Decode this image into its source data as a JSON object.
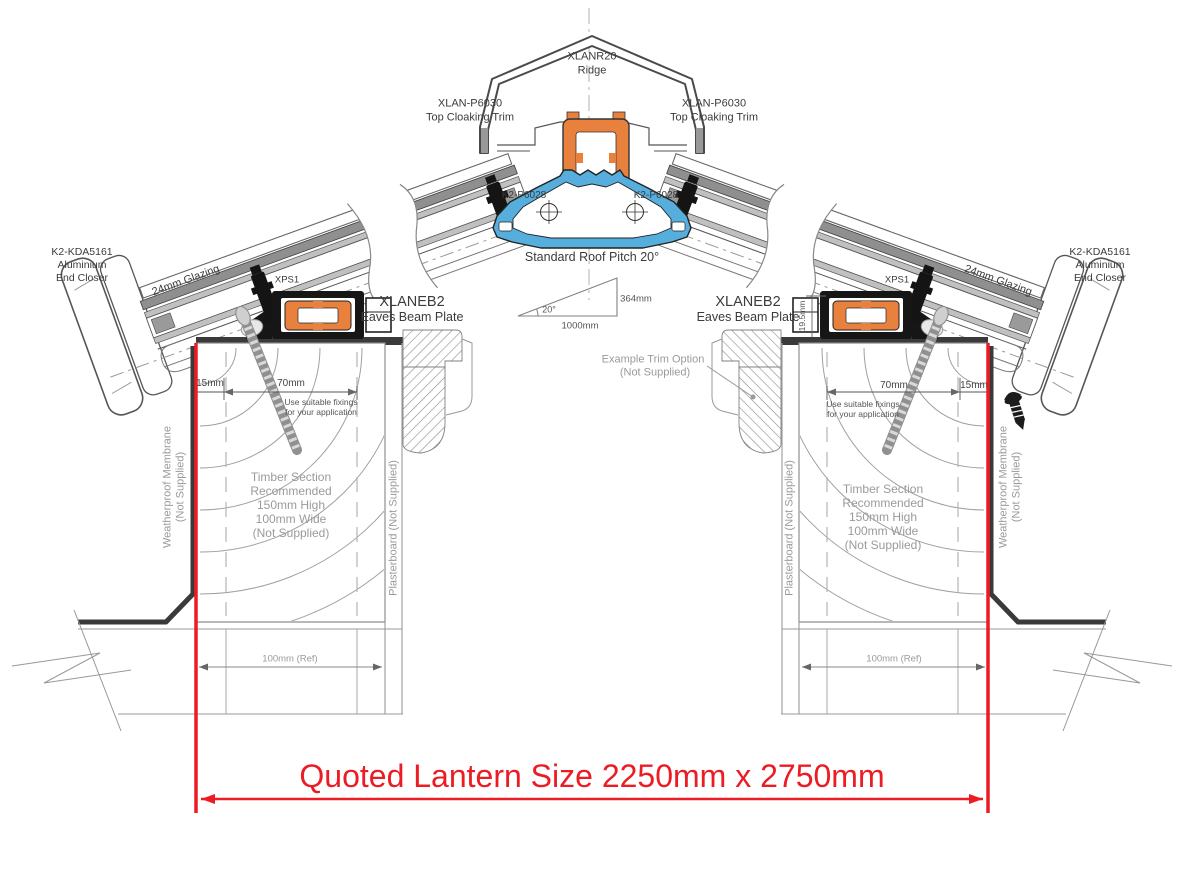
{
  "colors": {
    "accent_red": "#EC1C24",
    "profile_orange": "#E8803E",
    "profile_blue": "#55AEDC",
    "line_dark": "#3a3a3a",
    "annotation_gray": "#9a9a9a"
  },
  "labels": {
    "ridge_part": "XLANR20",
    "ridge_name": "Ridge",
    "cloaking_part": "XLAN-P6030",
    "cloaking_name": "Top Cloaking Trim",
    "ridge_bracket_part": "K2-P6028",
    "pitch_note": "Standard Roof Pitch 20°",
    "pitch_angle": "20°",
    "pitch_run": "1000mm",
    "pitch_rise": "364mm",
    "end_closer_part": "K2-KDA5161",
    "end_closer_material": "Aluminium",
    "end_closer_name": "End Closer",
    "glazing": "24mm Glazing",
    "thermal_spacer": "XPS1",
    "eaves_part": "XLANEB2",
    "eaves_name": "Eaves Beam Plate",
    "upstand_height": "19.5mm",
    "edge_offset": "15mm",
    "fixing_zone": "70mm",
    "fixings_note_1": "Use suitable fixings",
    "fixings_note_2": "for your application",
    "trim_option_1": "Example Trim Option",
    "trim_option_2": "(Not Supplied)",
    "timber_note": [
      "Timber Section",
      "Recommended",
      "150mm High",
      "100mm Wide",
      "(Not Supplied)"
    ],
    "membrane_1": "Weatherproof Membrane",
    "membrane_2": "(Not Supplied)",
    "plasterboard": "Plasterboard (Not Supplied)",
    "wall_ref": "100mm (Ref)",
    "quoted_size": "Quoted Lantern Size 2250mm x 2750mm"
  }
}
